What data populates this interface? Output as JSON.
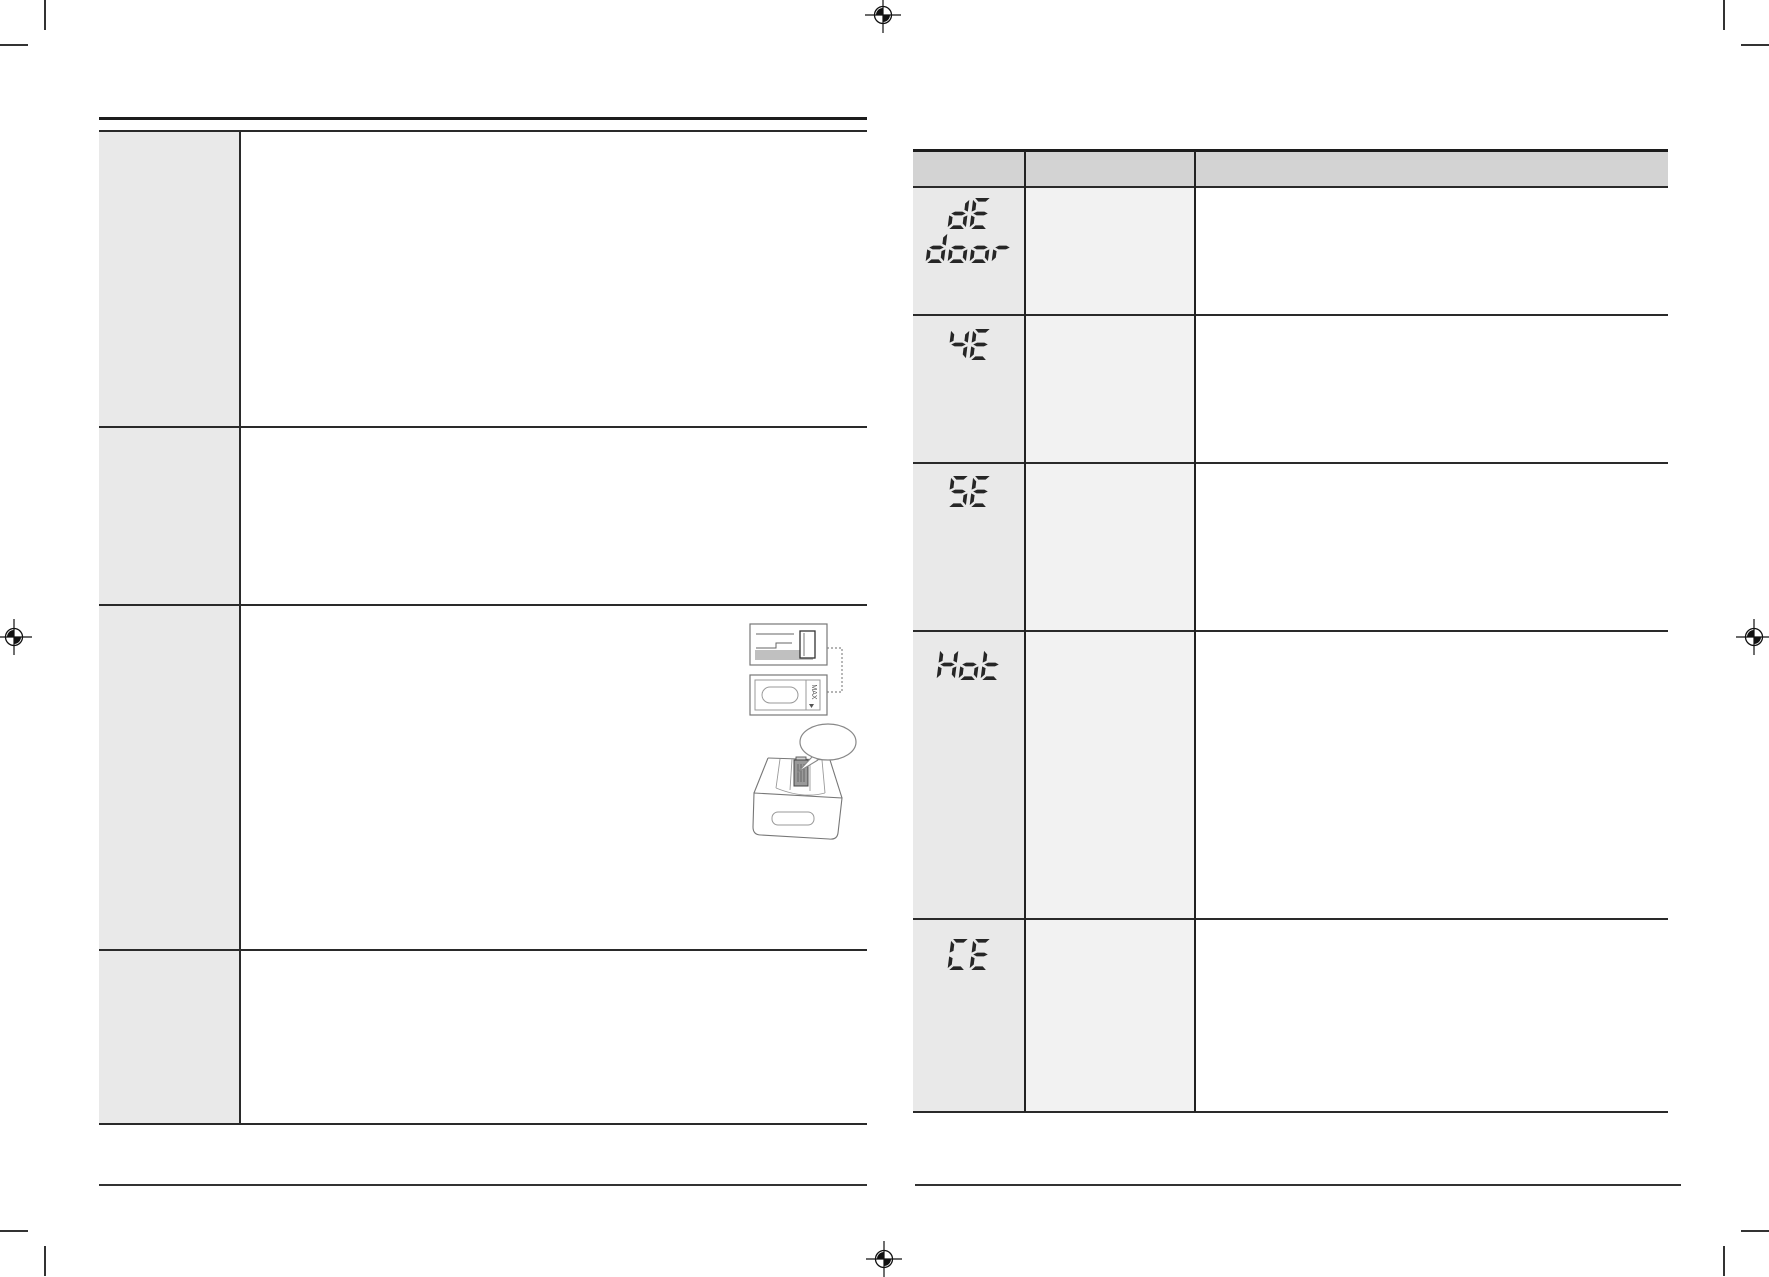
{
  "colors": {
    "header_gray": "#d3d3d3",
    "code_col_gray": "#e9e9e9",
    "cause_col_gray": "#f2f2f2",
    "rule_dark": "#1c1c1c",
    "line_dark": "#2a2a2a",
    "segment": "#262626",
    "sketch_stroke": "#777777",
    "sketch_shade": "#c0c0c0",
    "cap_shade": "#9a9a9a"
  },
  "right_table": {
    "error_codes": [
      {
        "id": "dE-door",
        "lines": [
          "dE",
          "door"
        ]
      },
      {
        "id": "4E",
        "lines": [
          "4E"
        ]
      },
      {
        "id": "5E",
        "lines": [
          "5E"
        ]
      },
      {
        "id": "Hot",
        "lines": [
          "Hot"
        ]
      },
      {
        "id": "CE",
        "lines": [
          "CE"
        ]
      }
    ]
  },
  "illustration": {
    "max_label": "MAX"
  }
}
